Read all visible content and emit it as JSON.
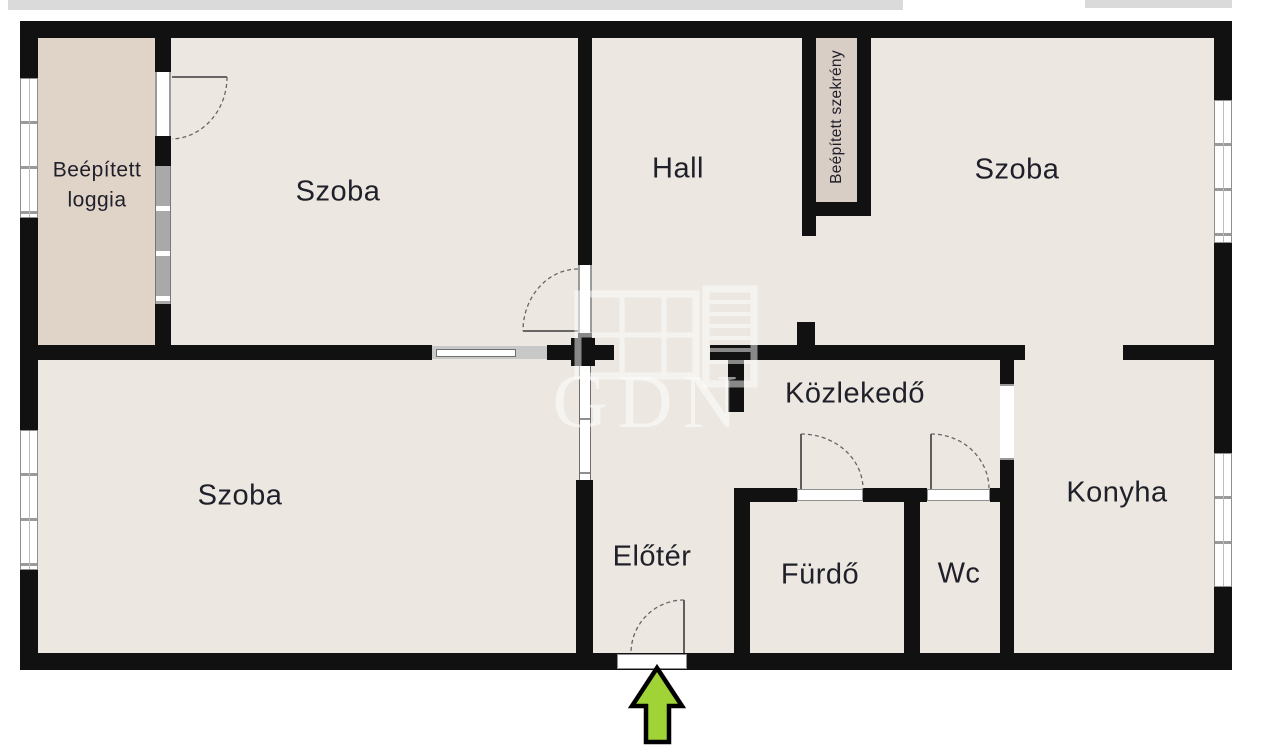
{
  "colors": {
    "wall": "#111111",
    "floor": "#ece8e1",
    "loggia_fill": "#e0d4c9",
    "closet_fill": "#d9cec5",
    "window_frame": "#8f8f8f",
    "label_text": "#20202a",
    "door_arc": "#666666",
    "door_leaf": "#3c3c3c",
    "arrow_fill": "#9fd336",
    "arrow_outline": "#000000",
    "watermark": "#ffffff",
    "artifact_strip": "#dadada"
  },
  "rooms": {
    "loggia": {
      "line1": "Beépített",
      "line2": "loggia"
    },
    "szoba_top_left": {
      "label": "Szoba"
    },
    "hall": {
      "label": "Hall"
    },
    "szekreny": {
      "label": "Beépített szekrény"
    },
    "szoba_top_right": {
      "label": "Szoba"
    },
    "szoba_bottom_left": {
      "label": "Szoba"
    },
    "kozlekedo": {
      "label": "Közlekedő"
    },
    "konyha": {
      "label": "Konyha"
    },
    "eloter": {
      "label": "Előtér"
    },
    "furdo": {
      "label": "Fürdő"
    },
    "wc": {
      "label": "Wc"
    }
  },
  "watermark": {
    "text": "GDN"
  },
  "entrance": {
    "arrow_direction": "up"
  }
}
